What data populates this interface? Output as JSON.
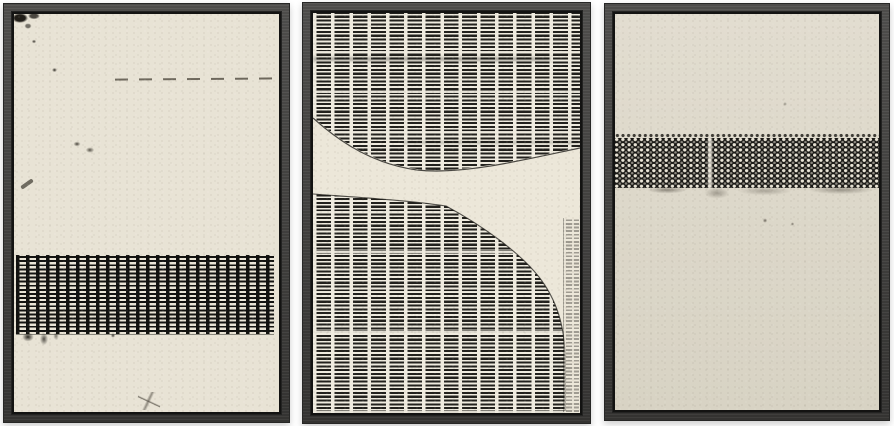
{
  "scene": {
    "type": "product-photo",
    "subject": "set of three framed abstract wall-art prints",
    "text_content": "none"
  },
  "colors": {
    "background": "#ffffff",
    "frame": "#3f3e3c",
    "frame_lip": "#131312",
    "ink": "#22211d",
    "canvas_left": "#e8e3d5",
    "canvas_mid": "#efebdf",
    "cream_mid": "#ece7d9",
    "canvas_right_top": "#e2ddd0",
    "canvas_right_bottom": "#d8d3c4"
  },
  "panels": [
    {
      "name": "left-artwork",
      "motif": "cream grunge canvas with black woven dash band across the lower third and scattered ink marks"
    },
    {
      "name": "middle-artwork",
      "motif": "dense columns of black horizontal dashes with a cream S-curve of negative space sweeping through the middle"
    },
    {
      "name": "right-artwork",
      "motif": "cream canvas with a black dotted weave band across the upper middle, dotted fringe above and smudges below"
    }
  ]
}
